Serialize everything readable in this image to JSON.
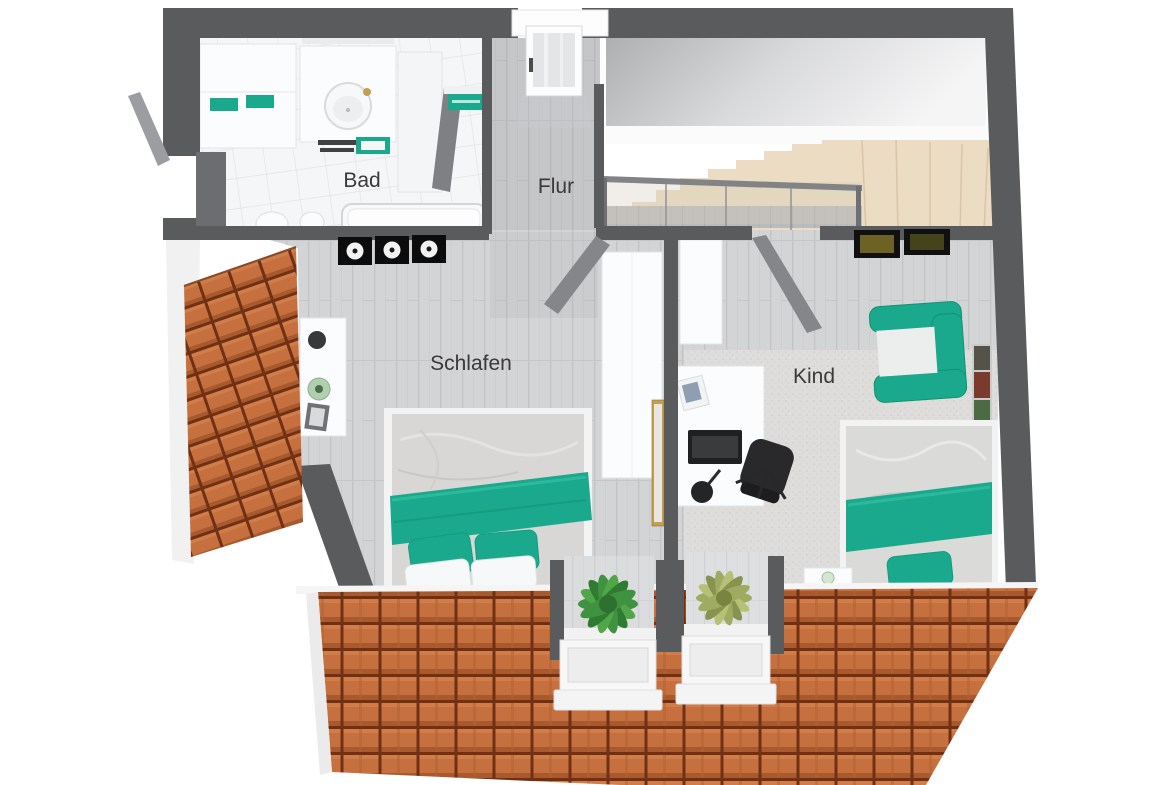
{
  "plan": {
    "type": "3d-floor-plan-top-view",
    "rooms": [
      {
        "id": "bad",
        "label": "Bad"
      },
      {
        "id": "flur",
        "label": "Flur"
      },
      {
        "id": "schlafen",
        "label": "Schlafen"
      },
      {
        "id": "kind",
        "label": "Kind"
      }
    ]
  },
  "colors": {
    "background": "#ffffff",
    "wall": "#595b5d",
    "door": "#84868a",
    "floor_wood": "#d3d4d6",
    "floor_tile": "#f5f6f7",
    "carpet": "#dedddb",
    "roof_tile": "#c7703f",
    "roof_gap": "#6f3014",
    "accent_teal": "#1aa98c",
    "stairs_beige": "#ebdcc3",
    "gold": "#c2a04f",
    "plant_dark": "#3f9340",
    "plant_light": "#9fab60",
    "label_text": "#3a3a3a"
  }
}
